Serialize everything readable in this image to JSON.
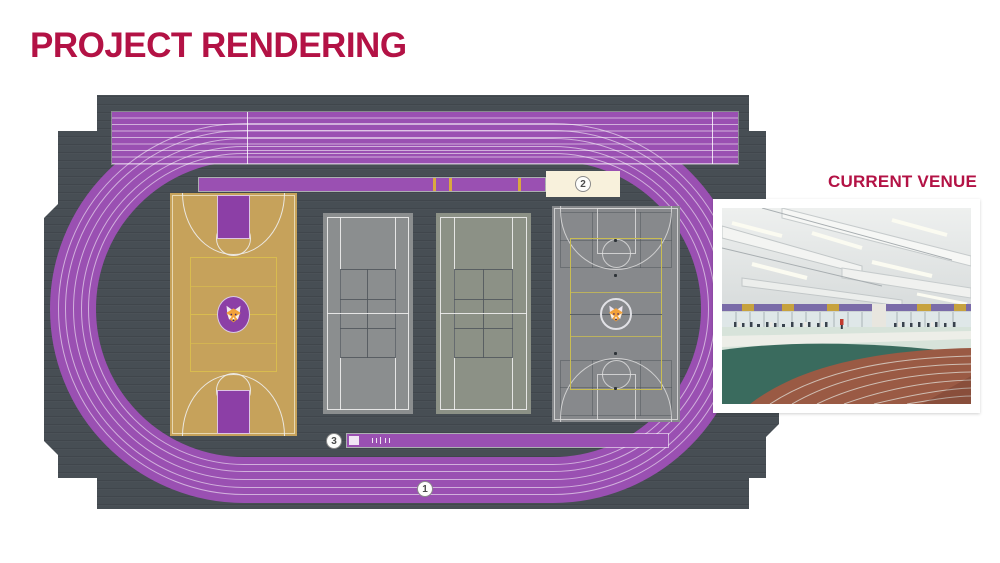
{
  "title": "PROJECT RENDERING",
  "current_venue": {
    "label": "CURRENT VENUE"
  },
  "callouts": {
    "one": "1",
    "two": "2",
    "three": "3"
  },
  "icons": {
    "fox_logo": "fox-mascot-logo",
    "fox_logo_count": "appears on basketball court center and multipurpose court center"
  },
  "colors": {
    "accent_crimson": "#B31245",
    "track_purple": "#9A50B2",
    "floor_slate": "#474E54",
    "court_tan": "#C6A25B",
    "court_line_yellow": "#D9BC4F",
    "court_gray": "#8B8E8F",
    "key_purple": "#8C3FA6",
    "callout_cream": "#F8F1DC",
    "logo_orange": "#F2A23A",
    "photo_track_terracotta": "#9A5A44",
    "photo_infield_green": "#3A6B5E"
  }
}
